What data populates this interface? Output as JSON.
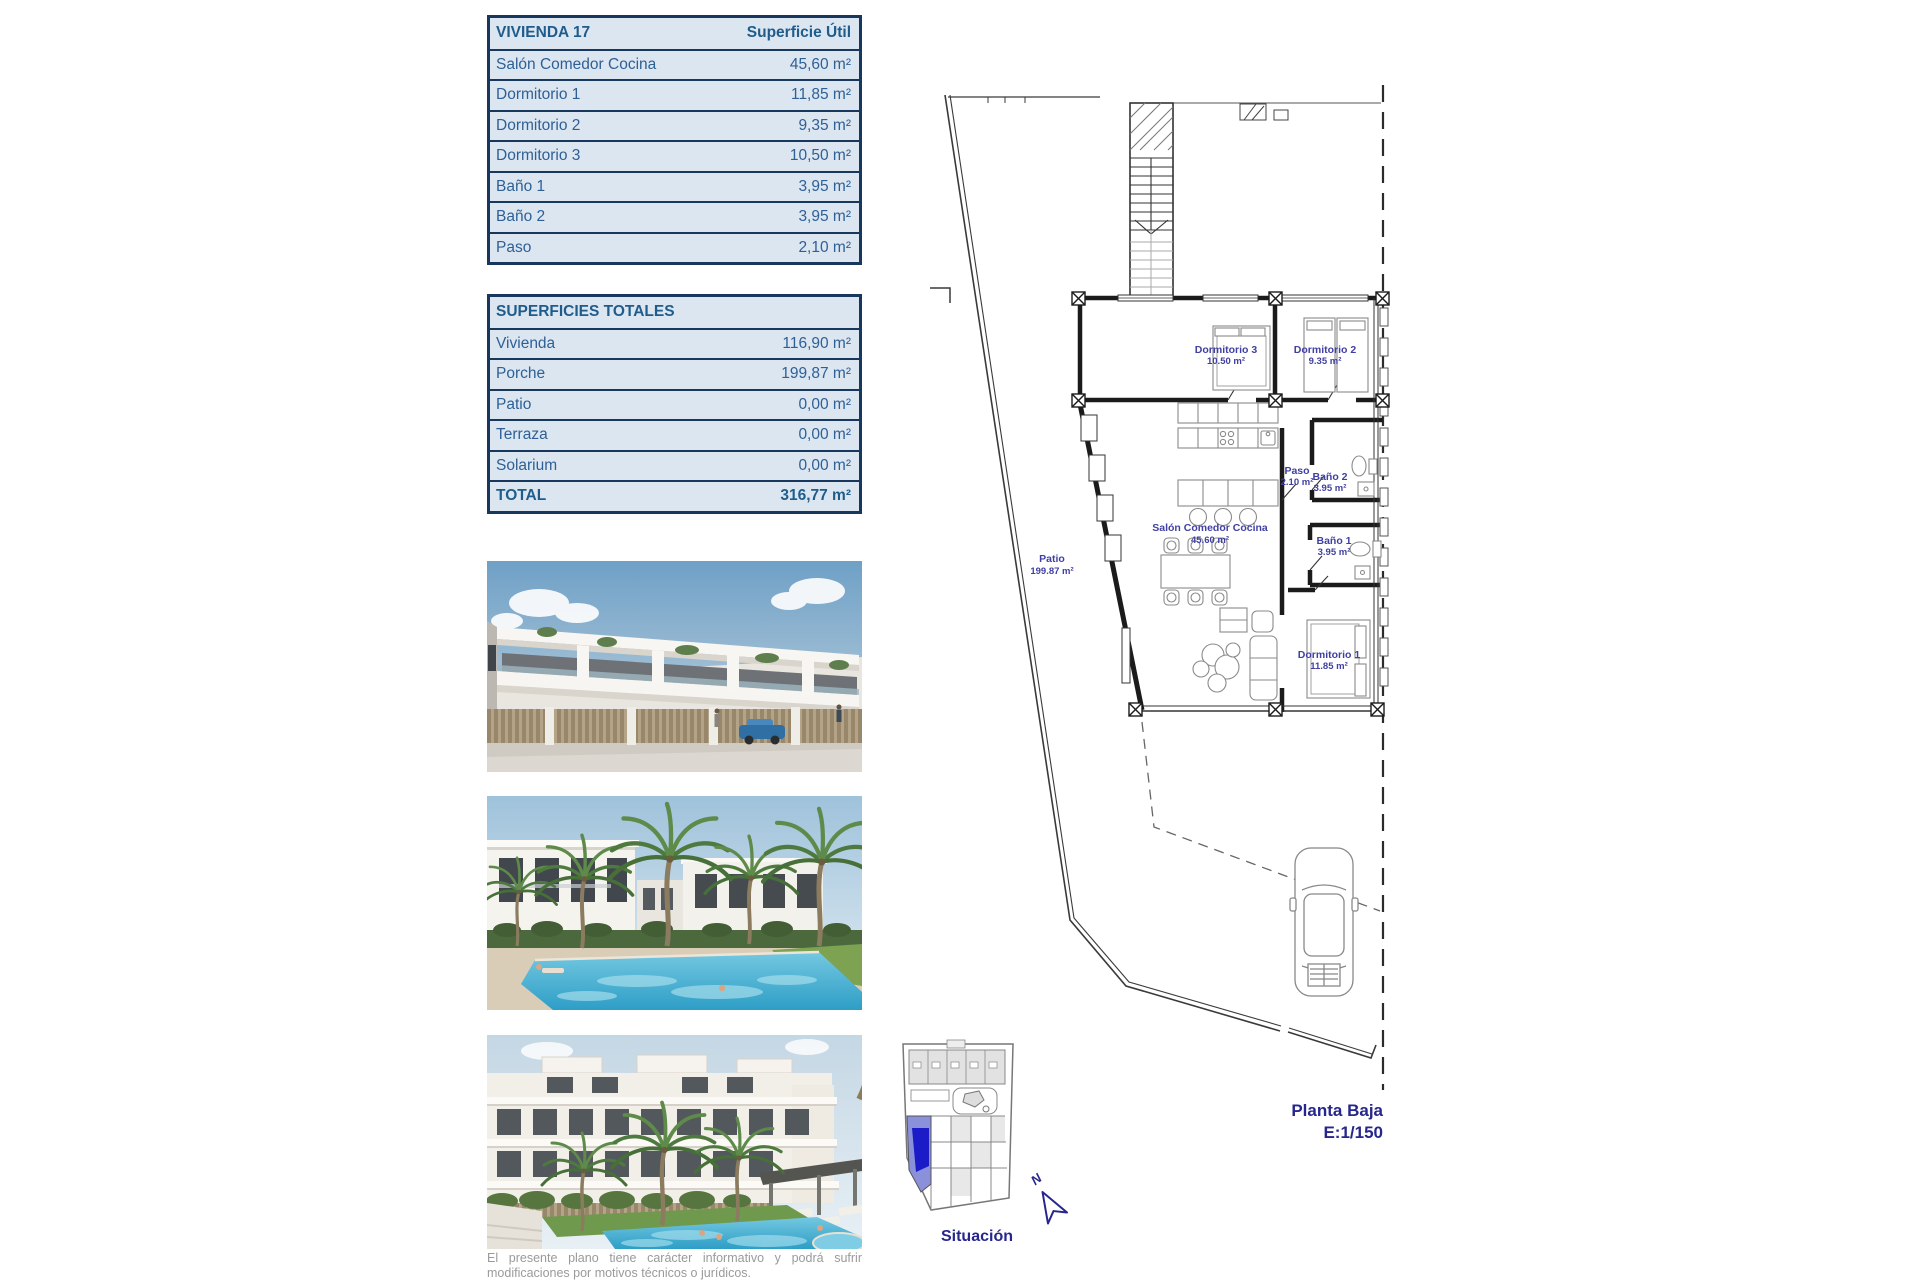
{
  "vivienda_table": {
    "title": "VIVIENDA 17",
    "header_value": "Superficie Útil",
    "rows": [
      {
        "label": "Salón Comedor Cocina",
        "value": "45,60 m²"
      },
      {
        "label": "Dormitorio 1",
        "value": "11,85 m²"
      },
      {
        "label": "Dormitorio 2",
        "value": "9,35 m²"
      },
      {
        "label": "Dormitorio 3",
        "value": "10,50 m²"
      },
      {
        "label": "Baño 1",
        "value": "3,95 m²"
      },
      {
        "label": "Baño 2",
        "value": "3,95 m²"
      },
      {
        "label": "Paso",
        "value": "2,10 m²"
      }
    ]
  },
  "totales_table": {
    "title": "SUPERFICIES TOTALES",
    "rows": [
      {
        "label": "Vivienda",
        "value": "116,90 m²"
      },
      {
        "label": "Porche",
        "value": "199,87 m²"
      },
      {
        "label": "Patio",
        "value": "0,00 m²"
      },
      {
        "label": "Terraza",
        "value": "0,00 m²"
      },
      {
        "label": "Solarium",
        "value": "0,00 m²"
      }
    ],
    "total": {
      "label": "TOTAL",
      "value": "316,77 m²"
    }
  },
  "plan": {
    "rooms": [
      {
        "name": "Dormitorio 3",
        "area": "10.50 m²"
      },
      {
        "name": "Dormitorio 2",
        "area": "9.35 m²"
      },
      {
        "name": "Paso",
        "area": "2.10 m²"
      },
      {
        "name": "Baño 2",
        "area": "3.95 m²"
      },
      {
        "name": "Baño 1",
        "area": "3.95 m²"
      },
      {
        "name": "Salón Comedor Cocina",
        "area": "45.60 m²"
      },
      {
        "name": "Dormitorio 1",
        "area": "11.85 m²"
      },
      {
        "name": "Patio",
        "area": "199.87 m²"
      }
    ],
    "caption_line1": "Planta Baja",
    "caption_line2": "E:1/150"
  },
  "situacion": {
    "label": "Situación",
    "north_label": "N"
  },
  "footer": {
    "disclaimer": "El presente plano tiene carácter informativo y podrá sufrir modificaciones por motivos técnicos o jurídicos."
  },
  "colors": {
    "table_border": "#17375D",
    "table_bg": "#DCE6F1",
    "table_text": "#2E6095",
    "plan_label": "#4040A2",
    "caption_navy": "#26268C",
    "parcel_highlight": "#1B1BC8",
    "parcel_highlight_light": "#8B90DA"
  }
}
